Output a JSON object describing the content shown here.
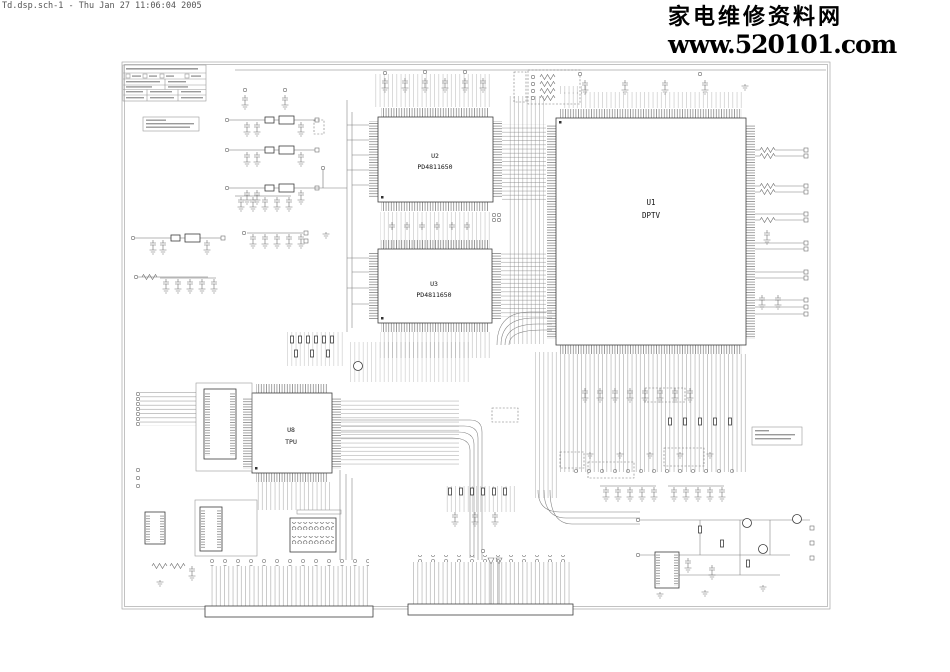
{
  "header": {
    "text": "Td.dsp.sch-1 - Thu Jan 27 11:06:04 2005"
  },
  "watermark": {
    "line1": "家电维修资料网",
    "line2": "www.520101.com"
  },
  "chips": {
    "u1": {
      "ref": "U1",
      "part": "DPTV"
    },
    "u2": {
      "ref": "U2",
      "part": "PD4811650"
    },
    "u3": {
      "ref": "U3",
      "part": "PD4811650"
    },
    "u8": {
      "ref": "U8",
      "part": "TPU"
    }
  },
  "colors": {
    "background": "#ffffff",
    "wire": "#6e6e6e",
    "component": "#3c3c3c",
    "sheet_border": "#9a9a9a",
    "text": "#000000",
    "header_text": "#555555"
  }
}
